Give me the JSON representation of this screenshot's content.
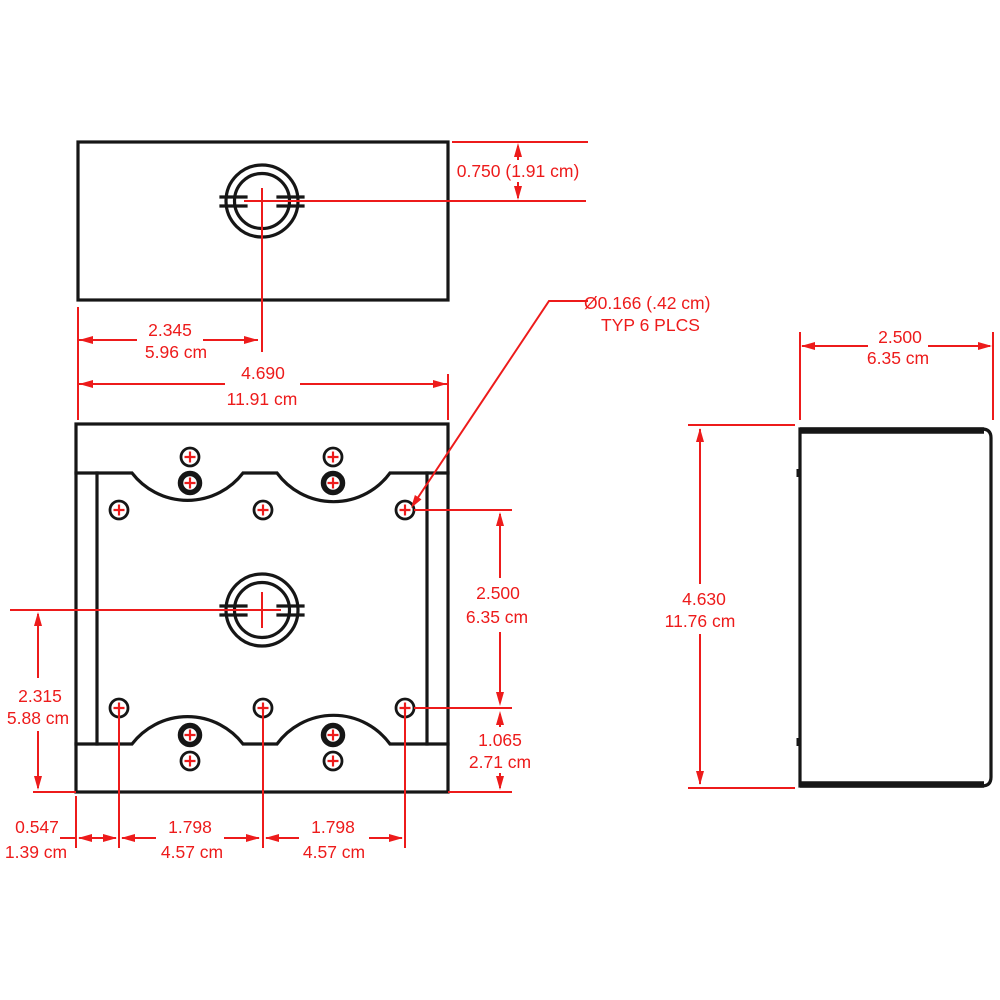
{
  "drawing_title": "Outlet box dimensional drawing (top, front and side views)",
  "colors": {
    "background": "#ffffff",
    "outline": "#161616",
    "dimension_red": "#ed1b1b"
  },
  "top_view": {
    "knockout_offset": {
      "label": "0.750 (1.91 cm)"
    },
    "knockout_center_x": {
      "inches": "2.345",
      "cm": "5.96 cm"
    }
  },
  "front_view": {
    "overall_width": {
      "inches": "4.690",
      "cm": "11.91 cm"
    },
    "hole_row_spacing": {
      "inches": "2.500",
      "cm": "6.35 cm"
    },
    "hole_to_bottom": {
      "inches": "1.065",
      "cm": "2.71 cm"
    },
    "center_to_bottom": {
      "inches": "2.315",
      "cm": "5.88 cm"
    },
    "edge_to_first_hole": {
      "inches": "0.547",
      "cm": "1.39 cm"
    },
    "hole_spacing_left": {
      "inches": "1.798",
      "cm": "4.57 cm"
    },
    "hole_spacing_right": {
      "inches": "1.798",
      "cm": "4.57 cm"
    },
    "mounting_hole_callout": {
      "line1": "Ø0.166 (.42 cm)",
      "line2": "TYP 6 PLCS"
    }
  },
  "side_view": {
    "depth": {
      "inches": "2.500",
      "cm": "6.35 cm"
    },
    "height": {
      "inches": "4.630",
      "cm": "11.76 cm"
    }
  }
}
